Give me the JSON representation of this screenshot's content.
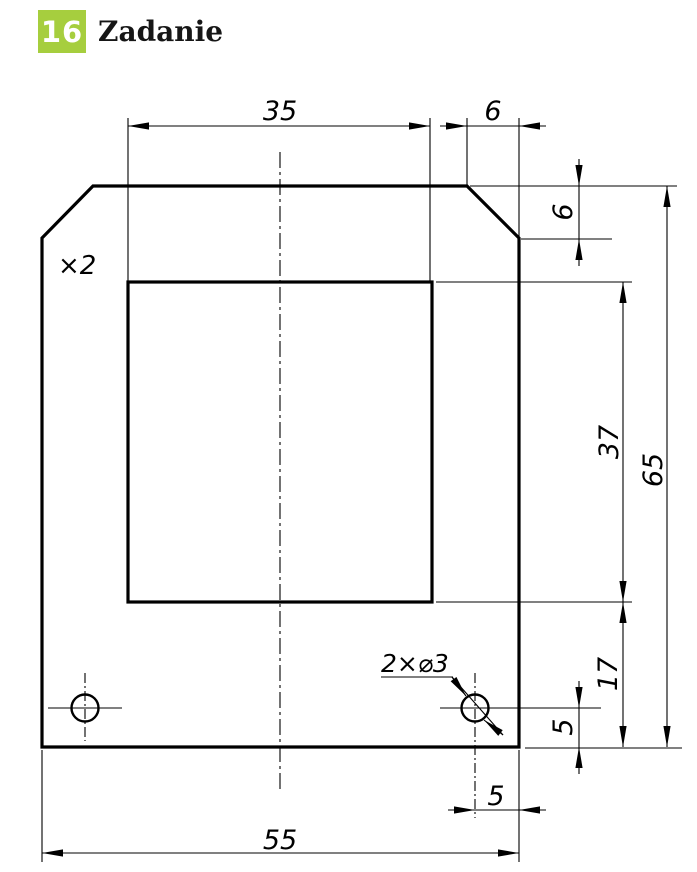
{
  "header": {
    "badge_number": "16",
    "title": "Zadanie",
    "badge_color": "#a6ce3e"
  },
  "drawing": {
    "multiplier_note": "×2",
    "hole_callout": "2×⌀3",
    "dims": {
      "inner_width": "35",
      "chamfer_width": "6",
      "chamfer_height": "6",
      "inner_height": "37",
      "total_height": "65",
      "lower_height": "17",
      "hole_bottom_offset": "5",
      "hole_side_offset": "5",
      "total_width": "55"
    },
    "line_color": "#000000"
  }
}
